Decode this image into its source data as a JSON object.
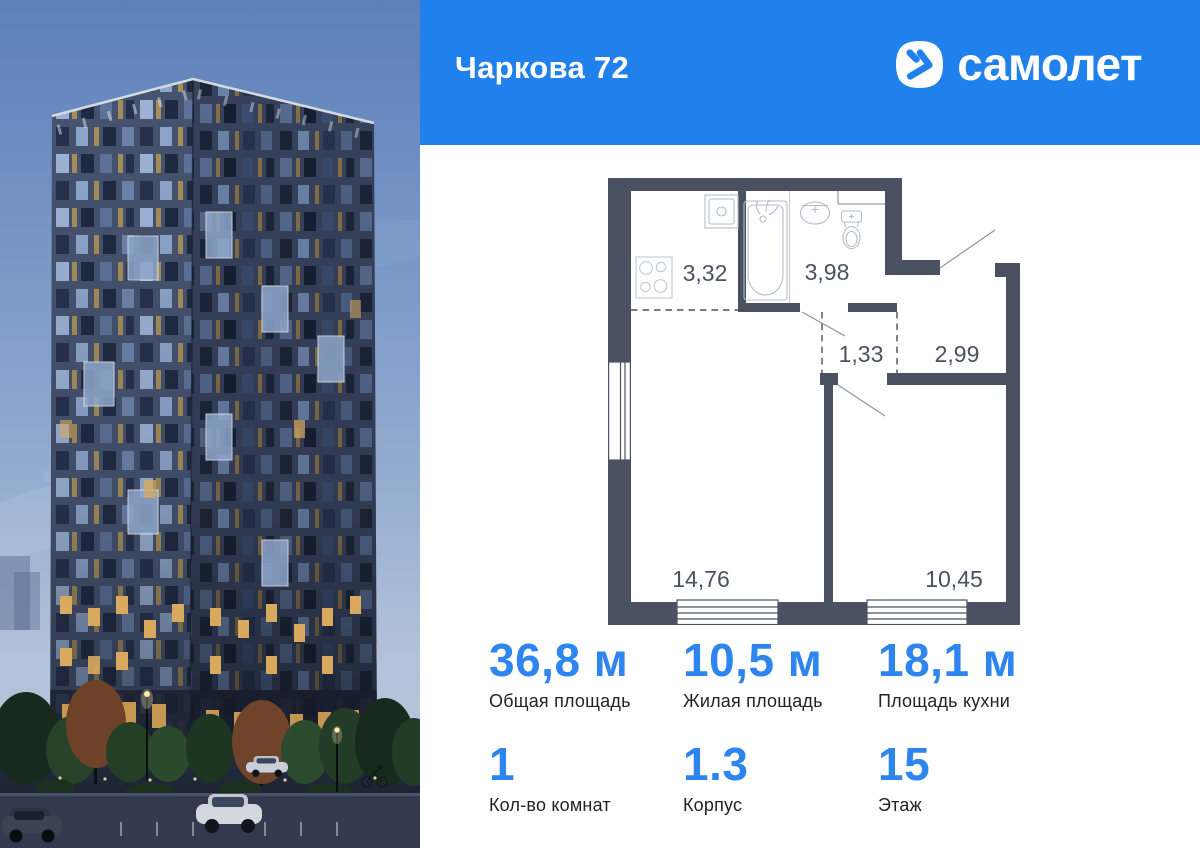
{
  "header": {
    "title": "Чаркова 72",
    "brand": "самолет",
    "background_color": "#2080ec"
  },
  "floor_plan": {
    "wall_color": "#4a5161",
    "areas": {
      "kitchen": "3,32",
      "bathroom": "3,98",
      "hallway": "1,33",
      "hall": "2,99",
      "living_room": "14,76",
      "bedroom": "10,45"
    }
  },
  "stats": {
    "accent_color": "#2f85f0",
    "total_area": {
      "value": "36,8 м",
      "label": "Общая площадь"
    },
    "living_area": {
      "value": "10,5 м",
      "label": "Жилая площадь"
    },
    "kitchen_area": {
      "value": "18,1 м",
      "label": "Площадь кухни"
    },
    "rooms": {
      "value": "1",
      "label": "Кол-во комнат"
    },
    "building": {
      "value": "1.3",
      "label": "Корпус"
    },
    "floor": {
      "value": "15",
      "label": "Этаж"
    }
  }
}
